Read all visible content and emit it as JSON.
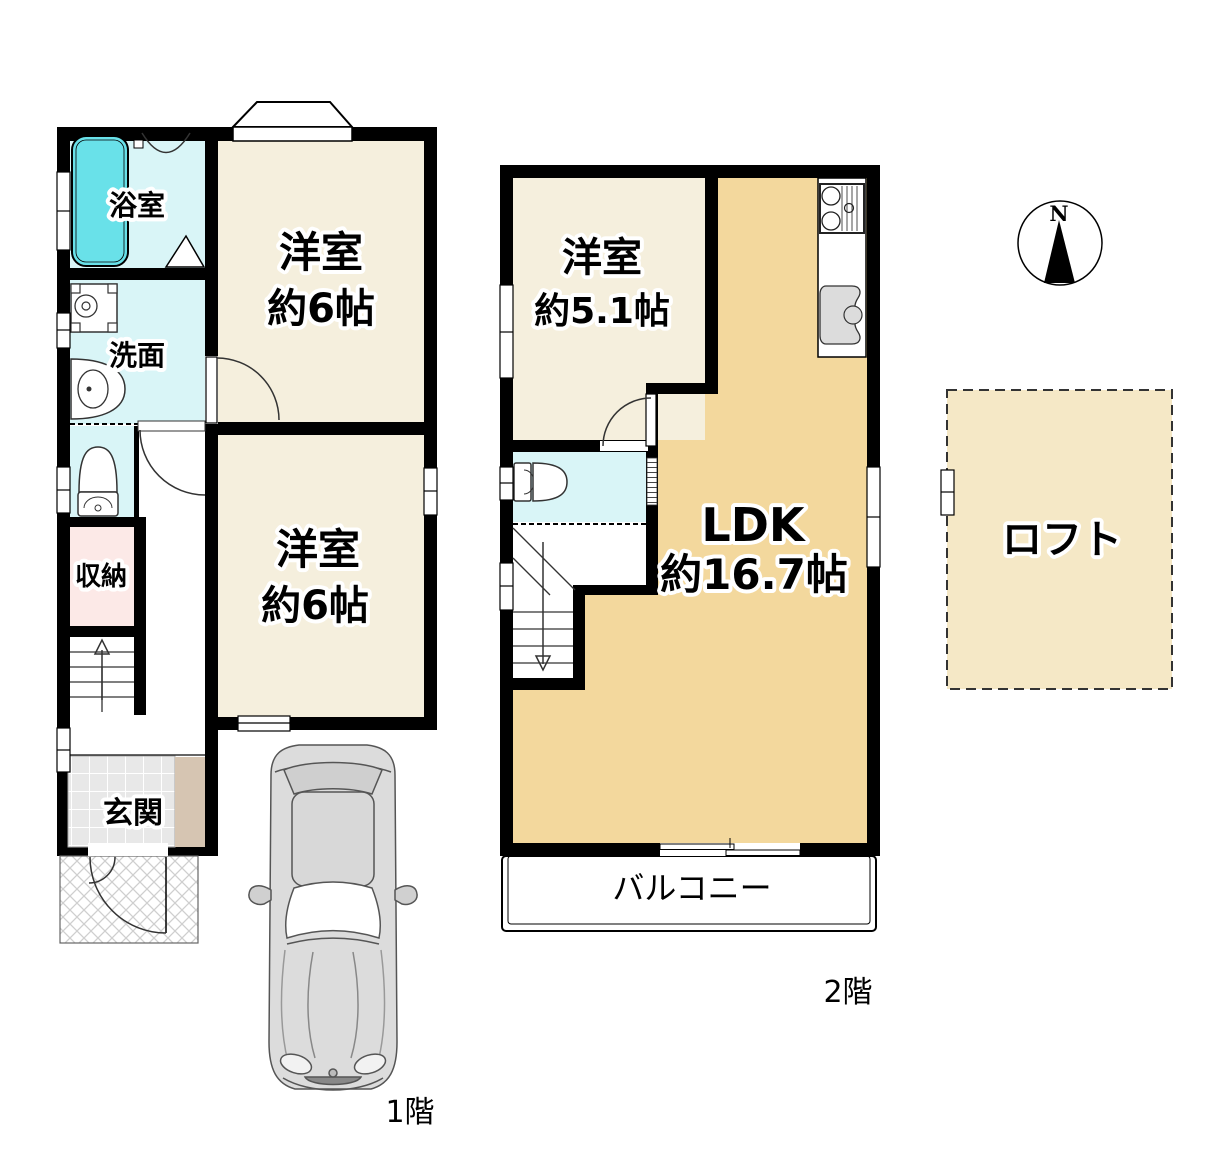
{
  "floor1": {
    "label": "1階",
    "rooms": {
      "bathroom": "浴室",
      "washroom": "洗面",
      "storage": "収納",
      "entrance": "玄関",
      "bedroom1": {
        "name": "洋室",
        "size": "約6帖"
      },
      "bedroom2": {
        "name": "洋室",
        "size": "約6帖"
      }
    }
  },
  "floor2": {
    "label": "2階",
    "rooms": {
      "bedroom": {
        "name": "洋室",
        "size": "約5.1帖"
      },
      "ldk": {
        "name": "LDK",
        "size": "約16.7帖"
      },
      "balcony": "バルコニー"
    }
  },
  "loft": {
    "label": "ロフト"
  },
  "compass": {
    "north_label": "N"
  },
  "colors": {
    "wall": "#000000",
    "bedroom_cream": "#f5efdd",
    "ldk_tan": "#f3d89d",
    "loft_beige": "#f5e8c6",
    "wet_area_cyan": "#d9f5f7",
    "bathtub_cyan": "#69e1e9",
    "storage_pink": "#fce9e7",
    "entrance_step_tan": "#d6c5b2",
    "tile_gray": "#e8e8e8",
    "car_gray": "#dcdcdc"
  }
}
